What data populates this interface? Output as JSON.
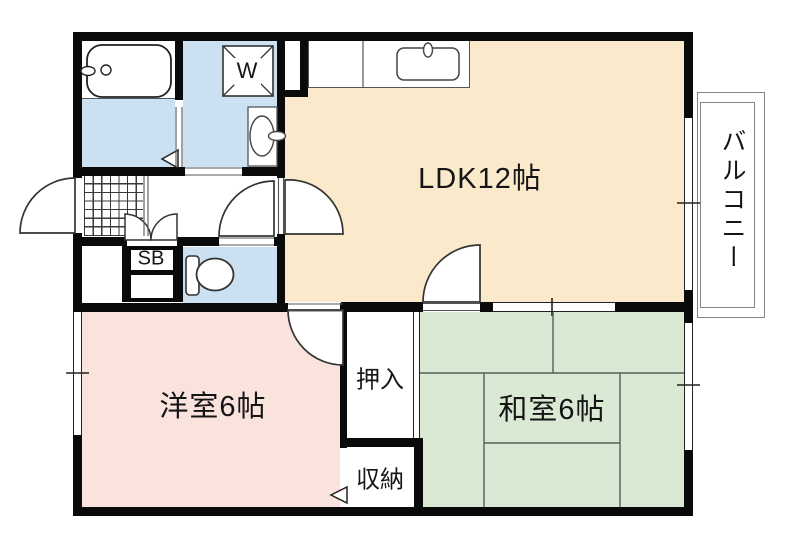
{
  "floorplan": {
    "title": "apartment-floor-plan",
    "rooms": {
      "ldk": {
        "label": "LDK12帖",
        "color": "#FBE9CB"
      },
      "western": {
        "label": "洋室6帖",
        "color": "#F9E3DC"
      },
      "japanese": {
        "label": "和室6帖",
        "color": "#DAE9D4"
      },
      "oshiire": {
        "label": "押入"
      },
      "shuno": {
        "label": "収納"
      },
      "balcony": {
        "label": "バルコニー"
      },
      "shoe_box": {
        "label": "SB"
      },
      "washer": {
        "label": "W"
      }
    },
    "colors": {
      "wall": "#0a0a0a",
      "wet_area": "#CBE1F1",
      "ldk": "#FBE9CB",
      "western": "#F9E3DC",
      "japanese": "#DAE9D4",
      "tatami_line": "#55605A",
      "fixture_line": "#333333",
      "balcony_line": "#858585"
    }
  }
}
